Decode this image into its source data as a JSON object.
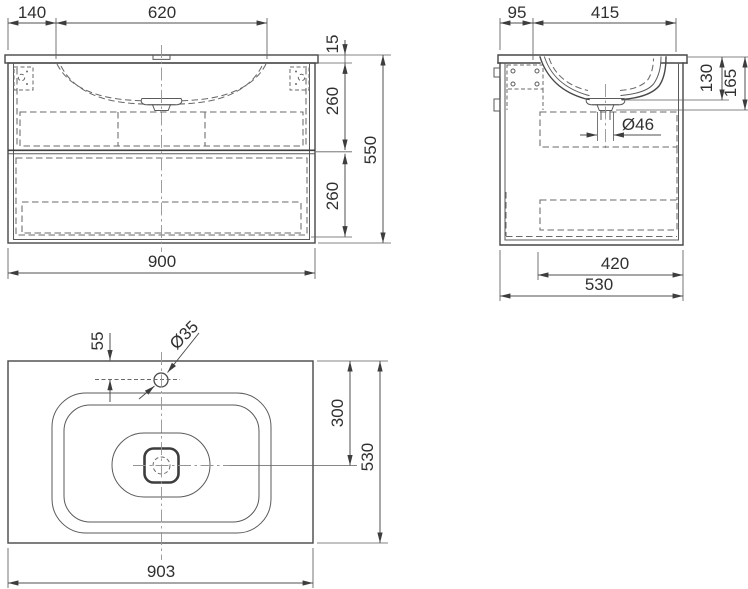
{
  "drawing_type": "washbasin-vanity-technical-drawing",
  "views": {
    "front": {
      "dims": {
        "offset_left": "140",
        "basin_width": "620",
        "countertop_thickness": "15",
        "upper_drawer_height": "260",
        "lower_drawer_height": "260",
        "total_height": "550",
        "total_width": "900"
      }
    },
    "side": {
      "dims": {
        "back_offset": "95",
        "basin_span": "415",
        "basin_depth": "130",
        "basin_total_depth": "165",
        "drain_diameter": "Ø46",
        "drawer_depth": "420",
        "total_depth": "530"
      }
    },
    "top": {
      "dims": {
        "faucet_offset": "55",
        "faucet_diameter": "Ø35",
        "drain_offset": "300",
        "total_depth": "530",
        "total_width": "903"
      }
    }
  },
  "colors": {
    "line": "#474747",
    "hidden_line": "#6a6a6a",
    "center_line": "#949494",
    "text": "#303030",
    "background": "#ffffff"
  }
}
